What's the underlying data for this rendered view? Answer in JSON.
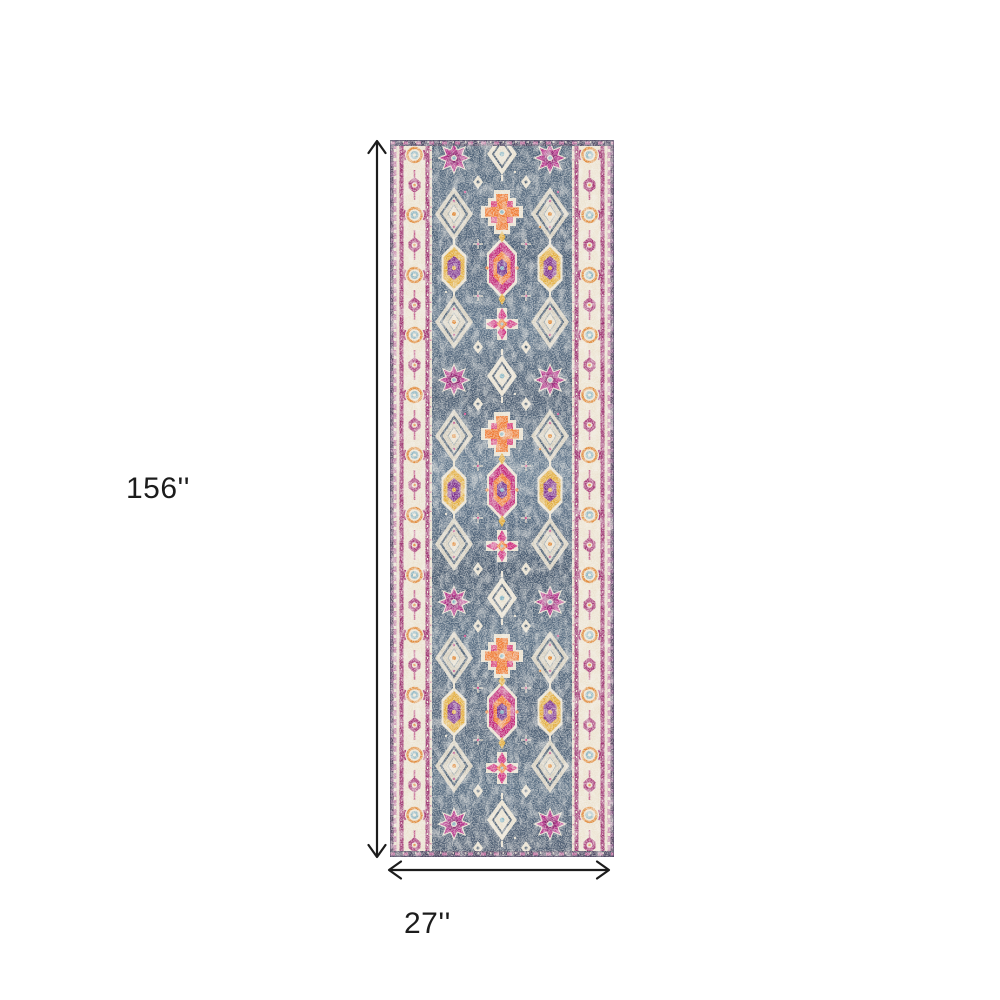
{
  "diagram": {
    "type": "product-dimension-diagram",
    "product": "distressed-oriental-runner-rug",
    "background": "#ffffff",
    "height_label": "156''",
    "width_label": "27''",
    "arrow_color": "#1c1c1c",
    "rug_palette": {
      "field_navy": "#44586e",
      "field_light": "#8fa3b3",
      "border_cream": "#ece3d1",
      "border_magenta": "#9c3370",
      "edge_plum": "#5e4a66",
      "accent_magenta": "#c02577",
      "accent_pink": "#d8447c",
      "accent_orange": "#ef7a33",
      "accent_gold": "#e2ac3c",
      "accent_purple": "#7b2d8b",
      "accent_teal": "#7fb0c0",
      "motif_cream": "#e9e1d0"
    },
    "motif_names": [
      "eight-point-star-medallion",
      "stepped-diamond-medallion",
      "hexagon-medallion",
      "rosette",
      "scroll-border-chain"
    ]
  }
}
